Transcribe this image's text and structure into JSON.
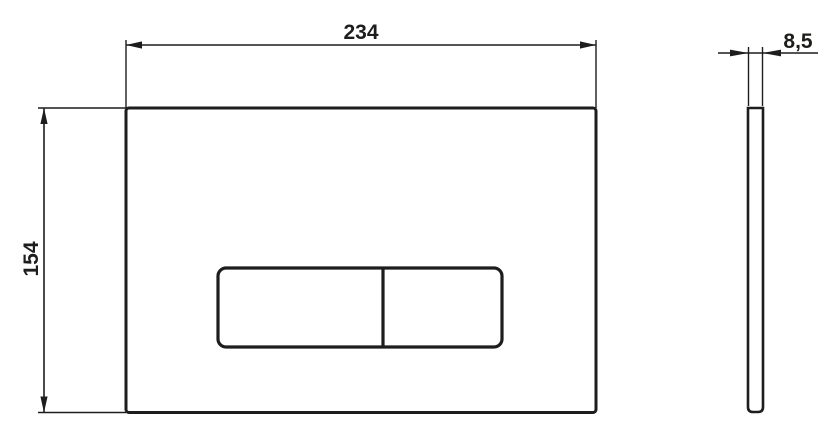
{
  "drawing": {
    "type": "technical-dimension-drawing",
    "views": {
      "front": "flush-plate-front-view",
      "side": "flush-plate-side-view"
    },
    "dimensions": {
      "width": "234",
      "height": "154",
      "thickness": "8,5"
    },
    "colors": {
      "line": "#1d1d1b",
      "background": "#ffffff"
    }
  }
}
